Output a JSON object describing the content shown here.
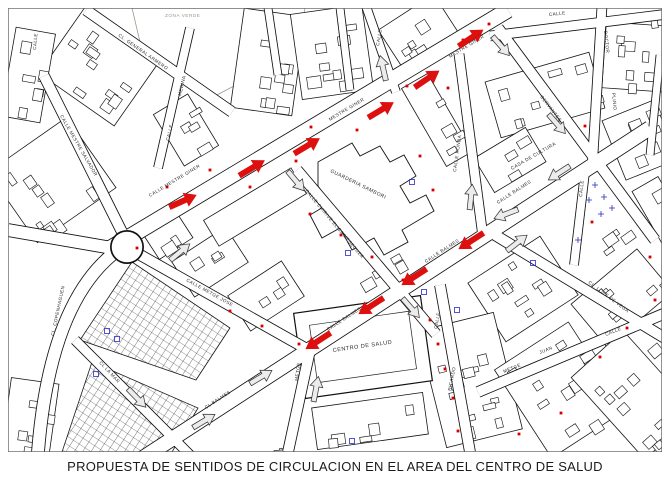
{
  "title": "PROPUESTA DE SENTIDOS DE CIRCULACION EN EL AREA DEL CENTRO DE SALUD",
  "map": {
    "background": "#ffffff",
    "ink": "#1a1a1a",
    "label_color": "#2a2a2a",
    "red": "#dd0f0f",
    "marker_red": "#d40000",
    "open_arrow_fill": "#ececec",
    "open_arrow_stroke": "#3c3c3c",
    "blue": "#2a2ac0",
    "green_zone_ink": "#9a9a8c",
    "street_labels": [
      {
        "text": "CALLE",
        "x": 36,
        "y": 50,
        "rot": -85
      },
      {
        "text": "CL. GENERAL ARMERO",
        "x": 118,
        "y": 36,
        "rot": 35
      },
      {
        "text": "CALLE",
        "x": 169,
        "y": 141,
        "rot": -77
      },
      {
        "text": "MEDINA",
        "x": 181,
        "y": 96,
        "rot": -77
      },
      {
        "text": "CALLE MESTRE SALVADOR",
        "x": 60,
        "y": 116,
        "rot": 60
      },
      {
        "text": "CALLE MESTRE GINER",
        "x": 150,
        "y": 197,
        "rot": -31
      },
      {
        "text": "MESTRE GINER",
        "x": 330,
        "y": 121,
        "rot": -31
      },
      {
        "text": "MESTRE GINER",
        "x": 450,
        "y": 58,
        "rot": -31
      },
      {
        "text": "CALLE",
        "x": 379,
        "y": 46,
        "rot": -80
      },
      {
        "text": "CALLE CHIRIVE ELISA MESEGUER",
        "x": 305,
        "y": 191,
        "rot": 50
      },
      {
        "text": "CALLE RONDA",
        "x": 456,
        "y": 172,
        "rot": -82
      },
      {
        "text": "CALLE",
        "x": 549,
        "y": 16,
        "rot": -6
      },
      {
        "text": "DOCTOR",
        "x": 604,
        "y": 31,
        "rot": 84
      },
      {
        "text": "PLINIO",
        "x": 612,
        "y": 93,
        "rot": 84
      },
      {
        "text": "CERVANTES",
        "x": 540,
        "y": 97,
        "rot": 52
      },
      {
        "text": "CALLE BALMES",
        "x": 498,
        "y": 204,
        "rot": -33
      },
      {
        "text": "CALLE",
        "x": 582,
        "y": 197,
        "rot": -84
      },
      {
        "text": "CALLE BALMES",
        "x": 426,
        "y": 263,
        "rot": -33
      },
      {
        "text": "CL. LOPE DE VEGA",
        "x": 588,
        "y": 283,
        "rot": 37
      },
      {
        "text": "CALLE BALMES",
        "x": 328,
        "y": 331,
        "rot": -33
      },
      {
        "text": "CALLE",
        "x": 437,
        "y": 329,
        "rot": -79
      },
      {
        "text": "RICARDO",
        "x": 451,
        "y": 391,
        "rot": -79
      },
      {
        "text": "METGE",
        "x": 298,
        "y": 381,
        "rot": -83
      },
      {
        "text": "CL BALMES",
        "x": 206,
        "y": 409,
        "rot": -33
      },
      {
        "text": "CL LA MAR",
        "x": 99,
        "y": 363,
        "rot": 47
      },
      {
        "text": "CL. COPENHAGUEN",
        "x": 54,
        "y": 336,
        "rot": -78
      },
      {
        "text": "CALLE METGE JOSE",
        "x": 186,
        "y": 281,
        "rot": 29
      },
      {
        "text": "METGE",
        "x": 504,
        "y": 373,
        "rot": -22
      },
      {
        "text": "JUAN",
        "x": 540,
        "y": 354,
        "rot": -22
      },
      {
        "text": "CALLE",
        "x": 606,
        "y": 336,
        "rot": -22
      }
    ],
    "building_labels": [
      {
        "text": "GUARDERIA SAMBORI",
        "x": 330,
        "y": 172,
        "rot": 26,
        "size": 5
      },
      {
        "text": "CASA DE CULTURA",
        "x": 512,
        "y": 170,
        "rot": -30,
        "size": 4.8
      },
      {
        "text": "CENTRO DE SALUD",
        "x": 333,
        "y": 352,
        "rot": -8,
        "size": 5.6
      }
    ],
    "zone_labels": [
      {
        "text": "ZONA VERDE",
        "x": 165,
        "y": 17,
        "rot": 0
      }
    ],
    "red_arrows": [
      {
        "x": 183,
        "y": 201,
        "rot": -24
      },
      {
        "x": 252,
        "y": 168,
        "rot": -31
      },
      {
        "x": 307,
        "y": 146,
        "rot": -31
      },
      {
        "x": 381,
        "y": 110,
        "rot": -31
      },
      {
        "x": 427,
        "y": 79,
        "rot": -34
      },
      {
        "x": 471,
        "y": 38,
        "rot": -34
      },
      {
        "x": 471,
        "y": 241,
        "rot": 147
      },
      {
        "x": 414,
        "y": 277,
        "rot": 147
      },
      {
        "x": 371,
        "y": 306,
        "rot": 147
      },
      {
        "x": 318,
        "y": 341,
        "rot": 147
      }
    ],
    "open_arrows": [
      {
        "x": 383,
        "y": 68,
        "rot": -103
      },
      {
        "x": 501,
        "y": 46,
        "rot": 49
      },
      {
        "x": 557,
        "y": 124,
        "rot": 49
      },
      {
        "x": 471,
        "y": 197,
        "rot": -84
      },
      {
        "x": 506,
        "y": 214,
        "rot": 159
      },
      {
        "x": 517,
        "y": 243,
        "rot": -38
      },
      {
        "x": 411,
        "y": 308,
        "rot": 49
      },
      {
        "x": 316,
        "y": 389,
        "rot": -79
      },
      {
        "x": 261,
        "y": 377,
        "rot": -31
      },
      {
        "x": 204,
        "y": 421,
        "rot": -31
      },
      {
        "x": 137,
        "y": 398,
        "rot": 46
      },
      {
        "x": 296,
        "y": 181,
        "rot": 50
      },
      {
        "x": 559,
        "y": 173,
        "rot": 147
      },
      {
        "x": 180,
        "y": 252,
        "rot": -40
      }
    ],
    "red_markers": [
      [
        137,
        248
      ],
      [
        167,
        187
      ],
      [
        210,
        170
      ],
      [
        250,
        187
      ],
      [
        296,
        161
      ],
      [
        311,
        127
      ],
      [
        357,
        130
      ],
      [
        407,
        86
      ],
      [
        448,
        88
      ],
      [
        463,
        40
      ],
      [
        489,
        24
      ],
      [
        310,
        214
      ],
      [
        341,
        235
      ],
      [
        372,
        257
      ],
      [
        403,
        280
      ],
      [
        420,
        156
      ],
      [
        433,
        190
      ],
      [
        299,
        344
      ],
      [
        262,
        326
      ],
      [
        230,
        311
      ],
      [
        430,
        320
      ],
      [
        438,
        344
      ],
      [
        445,
        369
      ],
      [
        453,
        398
      ],
      [
        458,
        431
      ],
      [
        519,
        434
      ],
      [
        561,
        413
      ],
      [
        600,
        357
      ],
      [
        627,
        328
      ],
      [
        655,
        300
      ],
      [
        592,
        222
      ],
      [
        650,
        257
      ],
      [
        585,
        126
      ]
    ],
    "blue_details": {
      "squares": [
        [
          424,
          292
        ],
        [
          457,
          310
        ],
        [
          533,
          263
        ],
        [
          107,
          331
        ],
        [
          117,
          339
        ],
        [
          348,
          253
        ],
        [
          412,
          182
        ],
        [
          96,
          374
        ],
        [
          352,
          441
        ]
      ],
      "crosses": [
        [
          595,
          185
        ],
        [
          604,
          197
        ],
        [
          612,
          208
        ],
        [
          589,
          200
        ],
        [
          601,
          214
        ],
        [
          578,
          240
        ]
      ]
    }
  }
}
